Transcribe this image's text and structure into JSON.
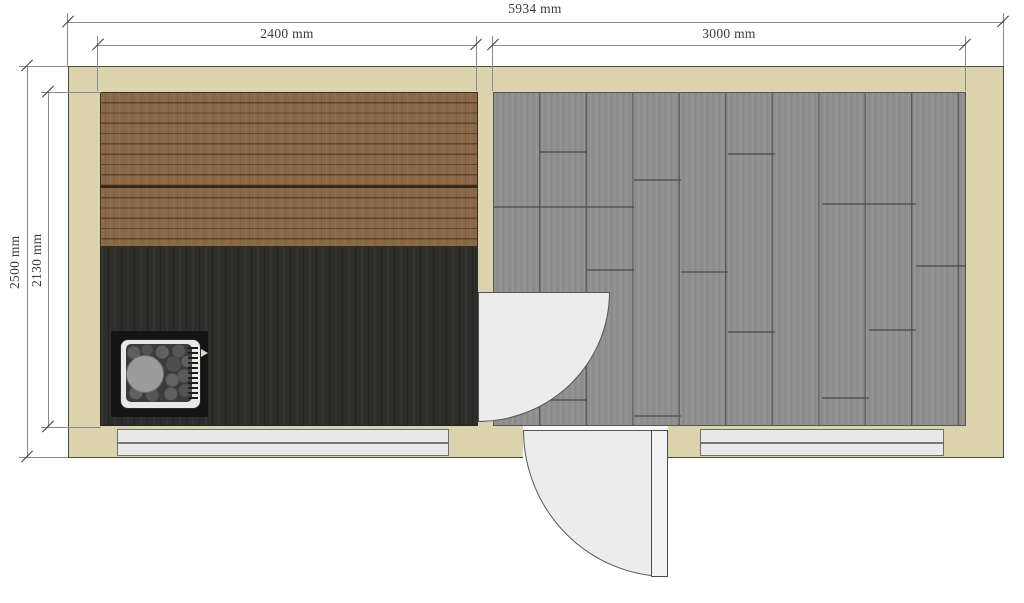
{
  "drawing": {
    "kind": "sauna-floor-plan",
    "dimensions": {
      "overall_width": "5934 mm",
      "left_room_width": "2400 mm",
      "right_room_width": "3000 mm",
      "overall_depth": "2500 mm",
      "interior_depth": "2130 mm"
    },
    "colors": {
      "wall": "#dbd3ae",
      "bench_wood": "#8a684a",
      "sauna_floor": "#2e2d2b",
      "terrace_floor": "#8f8f8f",
      "door_swing": "#ececec",
      "window": "#e9e9e9",
      "text": "#3a3a3a"
    }
  }
}
